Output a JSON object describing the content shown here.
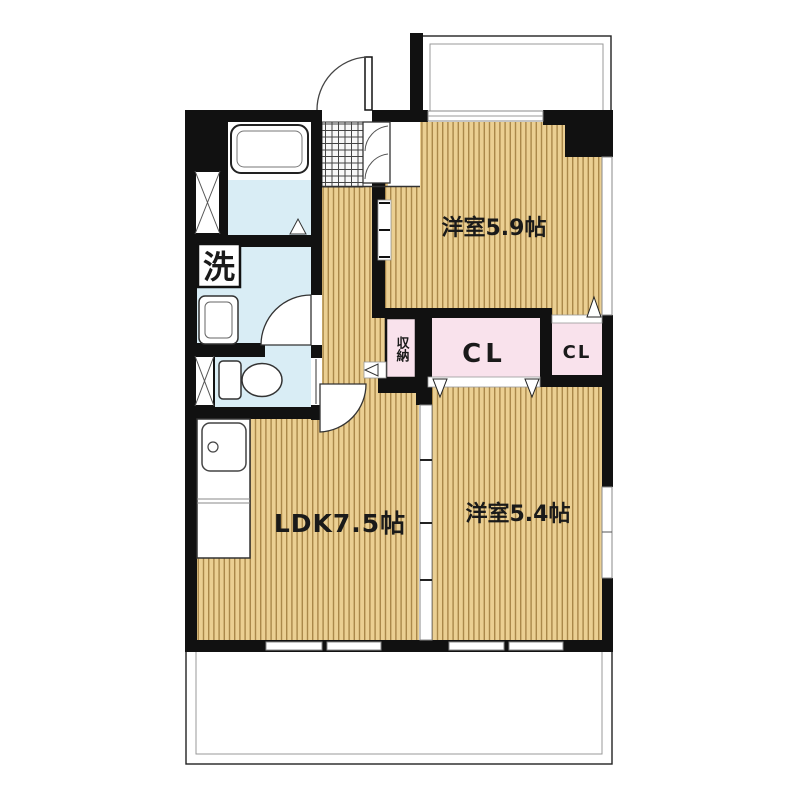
{
  "plan": {
    "type": "apartment-floor-plan",
    "labels": {
      "bedroom1": "洋室5.9帖",
      "ldk": "LDK7.5帖",
      "bedroom2": "洋室5.4帖",
      "closet_main": "CL",
      "closet_sub": "CL",
      "storage": "収納",
      "washer": "洗"
    },
    "colors": {
      "wall": "#111111",
      "wood_base": "#ebcf92",
      "wood_line": "#aa8749",
      "wet_area": "#d9edf5",
      "closet_pink": "#f9e2ec",
      "tile_bg": "#f8f8f8",
      "tile_line": "#444444",
      "fixture_outline": "#333333",
      "balcony_line": "#999999",
      "text": "#1a1a1a",
      "white": "#ffffff"
    }
  }
}
